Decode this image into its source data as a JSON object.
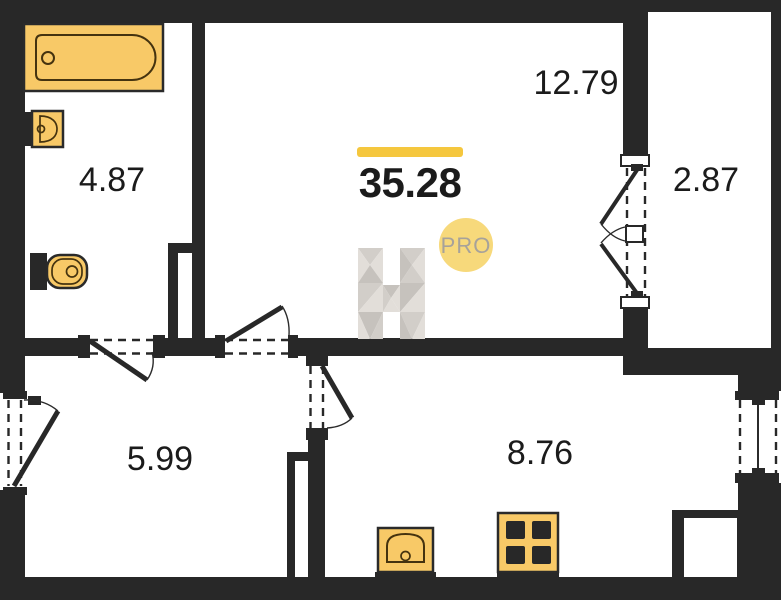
{
  "colors": {
    "wall": "#282828",
    "floor": "#ffffff",
    "label": "#1b1b1b",
    "fixture_fill": "#f8c967",
    "fixture_stroke": "#2a2a2a",
    "fixture_inner": "#45330f",
    "accent_bar": "#f5c73e",
    "pro_badge": "#f7d97b",
    "pro_text": "#a7a29a",
    "wm_light": "#e2ded9",
    "wm_mid": "#d2cec9",
    "wm_dark": "#c6c2bd"
  },
  "plan": {
    "total_area": "35.28",
    "rooms": [
      {
        "name": "living-room",
        "area": "12.79"
      },
      {
        "name": "bathroom",
        "area": "4.87"
      },
      {
        "name": "balcony",
        "area": "2.87"
      },
      {
        "name": "hallway",
        "area": "5.99"
      },
      {
        "name": "kitchen",
        "area": "8.76"
      }
    ],
    "watermark": {
      "letter": "H",
      "badge": "PRO"
    },
    "fixtures": [
      "bathtub",
      "sink",
      "toilet",
      "kitchen-sink",
      "stove"
    ]
  }
}
